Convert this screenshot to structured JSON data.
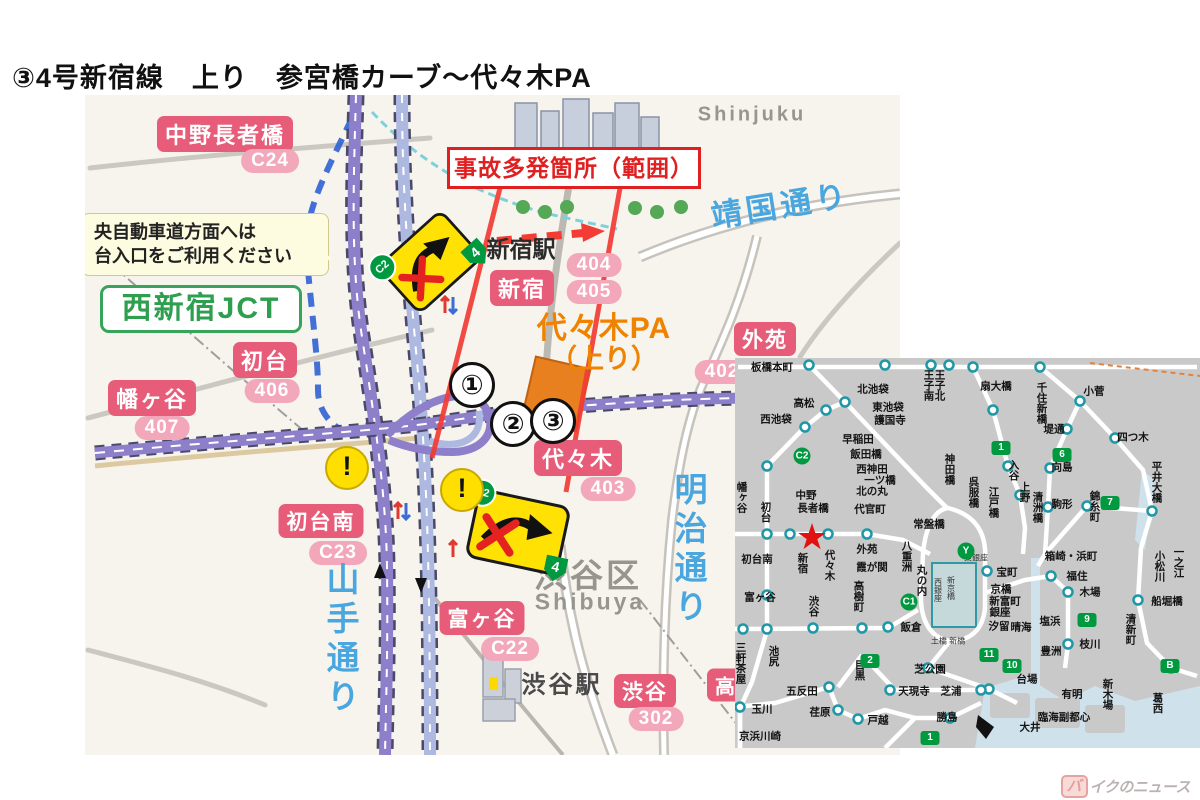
{
  "title": "③4号新宿線　上り　参宮橋カーブ～代々木PA",
  "watermark": {
    "prefix": "バ",
    "rest": "イクのニュース"
  },
  "colors": {
    "pink_box": "#e75d79",
    "pink_pill": "#f3a7ba",
    "expwy_purple": "#8d7fca",
    "expwy_lightblue": "#aeb9e2",
    "hazard_red": "#e02020",
    "overlay_red": "#f23c34",
    "pa_orange": "#ef8200",
    "jct_green": "#2e9e4f",
    "route_badge_green": "#00993f",
    "road_text_blue": "#4aa6de",
    "sign_yellow": "#ffe103",
    "inset_bg": "#c9c9c9"
  },
  "main_map": {
    "hazard_label": "事故多発箇所（範囲）",
    "note_lines": [
      "央自動車道方面へは",
      "台入口をご利用ください"
    ],
    "jct_label": "西新宿JCT",
    "pa_line1": "代々木PA",
    "pa_line2": "（上り）",
    "warning_glyph": "!",
    "markers": [
      {
        "t": "①",
        "cx": 472,
        "cy": 385
      },
      {
        "t": "②",
        "cx": 513,
        "cy": 424
      },
      {
        "t": "③",
        "cx": 553,
        "cy": 421
      }
    ],
    "warning_circles": [
      {
        "cx": 347,
        "cy": 468
      },
      {
        "cx": 462,
        "cy": 490
      }
    ],
    "warning_signs": [
      {
        "cx": 430,
        "cy": 262,
        "rot": -42,
        "w": 88,
        "h": 66,
        "badge": "C2",
        "route": "4"
      },
      {
        "cx": 518,
        "cy": 532,
        "rot": 12,
        "w": 96,
        "h": 72,
        "badge": "C2",
        "route": "4"
      }
    ],
    "labels": [
      {
        "t": "中野長者橋",
        "cls": "pbox",
        "cx": 225,
        "cy": 134
      },
      {
        "t": "C24",
        "cls": "ppill",
        "cx": 270,
        "cy": 161
      },
      {
        "t": "新宿",
        "cls": "pbox",
        "cx": 522,
        "cy": 288
      },
      {
        "t": "404",
        "cls": "ppill",
        "cx": 594,
        "cy": 265
      },
      {
        "t": "405",
        "cls": "ppill",
        "cx": 594,
        "cy": 292
      },
      {
        "t": "外苑",
        "cls": "pbox",
        "cx": 765,
        "cy": 339,
        "fs": 21
      },
      {
        "t": "402",
        "cls": "ppill",
        "cx": 722,
        "cy": 372
      },
      {
        "t": "代々木",
        "cls": "pbox",
        "cx": 578,
        "cy": 458
      },
      {
        "t": "403",
        "cls": "ppill",
        "cx": 608,
        "cy": 489
      },
      {
        "t": "初台",
        "cls": "pbox",
        "cx": 265,
        "cy": 360
      },
      {
        "t": "406",
        "cls": "ppill",
        "cx": 272,
        "cy": 391
      },
      {
        "t": "幡ヶ谷",
        "cls": "pbox",
        "cx": 152,
        "cy": 398
      },
      {
        "t": "407",
        "cls": "ppill",
        "cx": 162,
        "cy": 428
      },
      {
        "t": "初台南",
        "cls": "pbox",
        "cx": 321,
        "cy": 521,
        "fs": 21
      },
      {
        "t": "C23",
        "cls": "ppill",
        "cx": 338,
        "cy": 553
      },
      {
        "t": "富ヶ谷",
        "cls": "pbox",
        "cx": 482,
        "cy": 618,
        "fs": 21
      },
      {
        "t": "C22",
        "cls": "ppill",
        "cx": 510,
        "cy": 649
      },
      {
        "t": "渋谷",
        "cls": "pbox",
        "cx": 645,
        "cy": 691,
        "fs": 21
      },
      {
        "t": "302",
        "cls": "ppill",
        "cx": 656,
        "cy": 719
      },
      {
        "t": "高",
        "cls": "pbox",
        "cx": 726,
        "cy": 685,
        "fs": 20
      },
      {
        "t": "新宿駅",
        "cls": "btxt",
        "cx": 521,
        "cy": 247,
        "fs": 23
      },
      {
        "t": "渋谷駅",
        "cls": "btxt2",
        "cx": 562,
        "cy": 682,
        "fs": 24
      },
      {
        "t": "渋谷区",
        "cls": "gtxt",
        "cx": 588,
        "cy": 573,
        "fs": 33
      },
      {
        "t": "Shibuya",
        "cls": "gtxt",
        "cx": 590,
        "cy": 602,
        "fs": 23
      },
      {
        "t": "Shinjuku",
        "cls": "gtxt",
        "cx": 752,
        "cy": 115,
        "fs": 20
      },
      {
        "t": "山手通り",
        "cls": "bluev",
        "cx": 340,
        "cy": 640,
        "fs": 33
      },
      {
        "t": "明治通り",
        "cls": "bluev",
        "cx": 688,
        "cy": 550,
        "fs": 33
      },
      {
        "t": "靖国通り",
        "cls": "blueh",
        "cx": 780,
        "cy": 203,
        "fs": 31,
        "rot": -9
      }
    ]
  },
  "inset": {
    "star": {
      "glyph": "★",
      "cx": 812,
      "cy": 537
    },
    "stations": [
      {
        "t": "板橋本町",
        "cx": 772,
        "cy": 368
      },
      {
        "t": "北池袋",
        "cx": 873,
        "cy": 390
      },
      {
        "t": "東池袋",
        "cx": 888,
        "cy": 408
      },
      {
        "t": "護国寺",
        "cx": 890,
        "cy": 421
      },
      {
        "t": "高松",
        "cx": 804,
        "cy": 404
      },
      {
        "t": "西池袋",
        "cx": 776,
        "cy": 420
      },
      {
        "t": "早稲田",
        "cx": 858,
        "cy": 440
      },
      {
        "t": "飯田橋",
        "cx": 866,
        "cy": 455
      },
      {
        "t": "西神田",
        "cx": 872,
        "cy": 470
      },
      {
        "t": "一ツ橋",
        "cx": 880,
        "cy": 481
      },
      {
        "t": "北の丸",
        "cx": 872,
        "cy": 492
      },
      {
        "t": "代官町",
        "cx": 870,
        "cy": 510
      },
      {
        "t": "常盤橋",
        "cx": 929,
        "cy": 525
      },
      {
        "t": "八重洲",
        "cx": 906,
        "cy": 556,
        "v": 1
      },
      {
        "t": "丸の内",
        "cx": 921,
        "cy": 580,
        "v": 1
      },
      {
        "t": "神田橋",
        "cx": 949,
        "cy": 469,
        "v": 1
      },
      {
        "t": "王子南",
        "cx": 928,
        "cy": 385,
        "v": 1
      },
      {
        "t": "王子北",
        "cx": 939,
        "cy": 385,
        "v": 1
      },
      {
        "t": "扇大橋",
        "cx": 996,
        "cy": 387
      },
      {
        "t": "千住新橋",
        "cx": 1041,
        "cy": 403,
        "v": 1
      },
      {
        "t": "小菅",
        "cx": 1094,
        "cy": 392
      },
      {
        "t": "堤通",
        "cx": 1054,
        "cy": 430
      },
      {
        "t": "四つ木",
        "cx": 1133,
        "cy": 438
      },
      {
        "t": "向島",
        "cx": 1062,
        "cy": 468
      },
      {
        "t": "駒形",
        "cx": 1062,
        "cy": 505
      },
      {
        "t": "入谷",
        "cx": 1013,
        "cy": 470,
        "v": 1
      },
      {
        "t": "上野",
        "cx": 1024,
        "cy": 492,
        "v": 1
      },
      {
        "t": "呉服橋",
        "cx": 973,
        "cy": 492,
        "v": 1
      },
      {
        "t": "江戸橋",
        "cx": 993,
        "cy": 502,
        "v": 1
      },
      {
        "t": "清洲橋",
        "cx": 1037,
        "cy": 507,
        "v": 1
      },
      {
        "t": "錦糸町",
        "cx": 1094,
        "cy": 506,
        "v": 1
      },
      {
        "t": "平井大橋",
        "cx": 1156,
        "cy": 482,
        "v": 1
      },
      {
        "t": "中野",
        "cx": 806,
        "cy": 496
      },
      {
        "t": "長者橋",
        "cx": 813,
        "cy": 509
      },
      {
        "t": "幡ヶ谷",
        "cx": 741,
        "cy": 497,
        "v": 1
      },
      {
        "t": "初台",
        "cx": 765,
        "cy": 512,
        "v": 1
      },
      {
        "t": "初台南",
        "cx": 757,
        "cy": 560
      },
      {
        "t": "富ヶ谷",
        "cx": 760,
        "cy": 598
      },
      {
        "t": "新宿",
        "cx": 802,
        "cy": 563,
        "v": 1
      },
      {
        "t": "代々木",
        "cx": 829,
        "cy": 565,
        "v": 1
      },
      {
        "t": "渋谷",
        "cx": 813,
        "cy": 606,
        "v": 1
      },
      {
        "t": "外苑",
        "cx": 867,
        "cy": 550
      },
      {
        "t": "霞が関",
        "cx": 872,
        "cy": 568
      },
      {
        "t": "高樹町",
        "cx": 858,
        "cy": 596,
        "v": 1
      },
      {
        "t": "三軒茶屋",
        "cx": 740,
        "cy": 663,
        "v": 1
      },
      {
        "t": "池尻",
        "cx": 773,
        "cy": 656,
        "v": 1
      },
      {
        "t": "目黒",
        "cx": 859,
        "cy": 670,
        "v": 1
      },
      {
        "t": "飯倉",
        "cx": 911,
        "cy": 628
      },
      {
        "t": "芝公園",
        "cx": 930,
        "cy": 670
      },
      {
        "t": "天現寺",
        "cx": 914,
        "cy": 692
      },
      {
        "t": "芝浦",
        "cx": 951,
        "cy": 692
      },
      {
        "t": "五反田",
        "cx": 802,
        "cy": 692
      },
      {
        "t": "玉川",
        "cx": 762,
        "cy": 710
      },
      {
        "t": "荏原",
        "cx": 820,
        "cy": 713
      },
      {
        "t": "戸越",
        "cx": 878,
        "cy": 721
      },
      {
        "t": "勝島",
        "cx": 947,
        "cy": 718
      },
      {
        "t": "京浜川崎",
        "cx": 760,
        "cy": 737
      },
      {
        "t": "箱崎・浜町",
        "cx": 1071,
        "cy": 557
      },
      {
        "t": "宝町",
        "cx": 1007,
        "cy": 573
      },
      {
        "t": "福住",
        "cx": 1077,
        "cy": 577
      },
      {
        "t": "京橋",
        "cx": 1001,
        "cy": 590
      },
      {
        "t": "新富町",
        "cx": 1005,
        "cy": 602
      },
      {
        "t": "銀座",
        "cx": 1000,
        "cy": 613
      },
      {
        "t": "汐留",
        "cx": 999,
        "cy": 627
      },
      {
        "t": "晴海",
        "cx": 1021,
        "cy": 628
      },
      {
        "t": "塩浜",
        "cx": 1050,
        "cy": 622
      },
      {
        "t": "木場",
        "cx": 1090,
        "cy": 593
      },
      {
        "t": "枝川",
        "cx": 1090,
        "cy": 645
      },
      {
        "t": "豊洲",
        "cx": 1051,
        "cy": 652
      },
      {
        "t": "船堀橋",
        "cx": 1167,
        "cy": 602
      },
      {
        "t": "清新町",
        "cx": 1130,
        "cy": 629,
        "v": 1
      },
      {
        "t": "葛西",
        "cx": 1157,
        "cy": 703,
        "v": 1
      },
      {
        "t": "小松川",
        "cx": 1159,
        "cy": 566,
        "v": 1
      },
      {
        "t": "一之江",
        "cx": 1178,
        "cy": 562,
        "v": 1
      },
      {
        "t": "台場",
        "cx": 1027,
        "cy": 680
      },
      {
        "t": "有明",
        "cx": 1072,
        "cy": 695
      },
      {
        "t": "新木場",
        "cx": 1107,
        "cy": 694,
        "v": 1
      },
      {
        "t": "臨海副都心",
        "cx": 1064,
        "cy": 718
      },
      {
        "t": "大井",
        "cx": 1030,
        "cy": 728
      }
    ],
    "small_texts": [
      {
        "t": "新京橋",
        "cx": 951,
        "cy": 588,
        "v": 1
      },
      {
        "t": "西銀座",
        "cx": 938,
        "cy": 590,
        "v": 1
      },
      {
        "t": "東銀座",
        "cx": 976,
        "cy": 558
      },
      {
        "t": "土橋 新橋",
        "cx": 948,
        "cy": 641
      }
    ],
    "badges": [
      {
        "t": "C2",
        "cx": 802,
        "cy": 456,
        "shape": "circ"
      },
      {
        "t": "C1",
        "cx": 909,
        "cy": 602,
        "shape": "circ"
      },
      {
        "t": "Y",
        "cx": 966,
        "cy": 551,
        "shape": "circ"
      },
      {
        "t": "1",
        "cx": 1001,
        "cy": 448,
        "shape": "sq"
      },
      {
        "t": "6",
        "cx": 1062,
        "cy": 455,
        "shape": "sq"
      },
      {
        "t": "7",
        "cx": 1110,
        "cy": 503,
        "shape": "sq"
      },
      {
        "t": "2",
        "cx": 870,
        "cy": 661,
        "shape": "sq"
      },
      {
        "t": "9",
        "cx": 1087,
        "cy": 620,
        "shape": "sq"
      },
      {
        "t": "10",
        "cx": 1012,
        "cy": 666,
        "shape": "sq"
      },
      {
        "t": "11",
        "cx": 989,
        "cy": 655,
        "shape": "sq"
      },
      {
        "t": "B",
        "cx": 1170,
        "cy": 666,
        "shape": "sq"
      },
      {
        "t": "1",
        "cx": 930,
        "cy": 738,
        "shape": "sq"
      }
    ]
  }
}
